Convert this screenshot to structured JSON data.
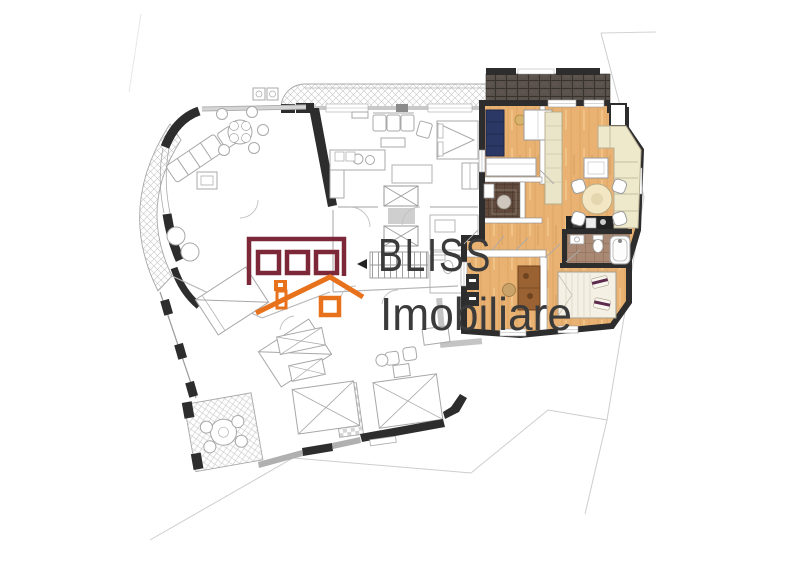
{
  "page": {
    "background_color": "#ffffff",
    "content_type": "residential floor plan with one highlighted apartment"
  },
  "watermark": {
    "line1": "BLISS",
    "line2": "Imobiliare",
    "text_color": "#3b3b3b",
    "logo": {
      "name": "house-facade-logo",
      "building_color": "#7d2838",
      "roof_color": "#e8711c"
    }
  },
  "floor_plan": {
    "line_art_color": "#a8a8a8",
    "structural_wall_color": "#2d2d2d",
    "highlighted_unit": {
      "floor_color": "#e9b273",
      "terrace_tile_color": "#58504a",
      "blue_sofa_color": "#2b3866",
      "bathroom_tile_color": "#a98974",
      "shower_room_tile_color": "#61493c",
      "cream_sofa_color": "#efe9cb",
      "bed_pillow_accent_color": "#5d2a4e",
      "rooms": [
        "terrace",
        "office",
        "shower-room",
        "hallway",
        "living-room",
        "dining-area",
        "kitchen",
        "bathroom",
        "bedroom"
      ]
    },
    "gray_wing_features": [
      "curved-balcony",
      "top-balcony-strip",
      "living-room",
      "dining-table",
      "elevator-core",
      "staircase",
      "bedrooms",
      "tiled-terrace",
      "bathrooms"
    ]
  }
}
